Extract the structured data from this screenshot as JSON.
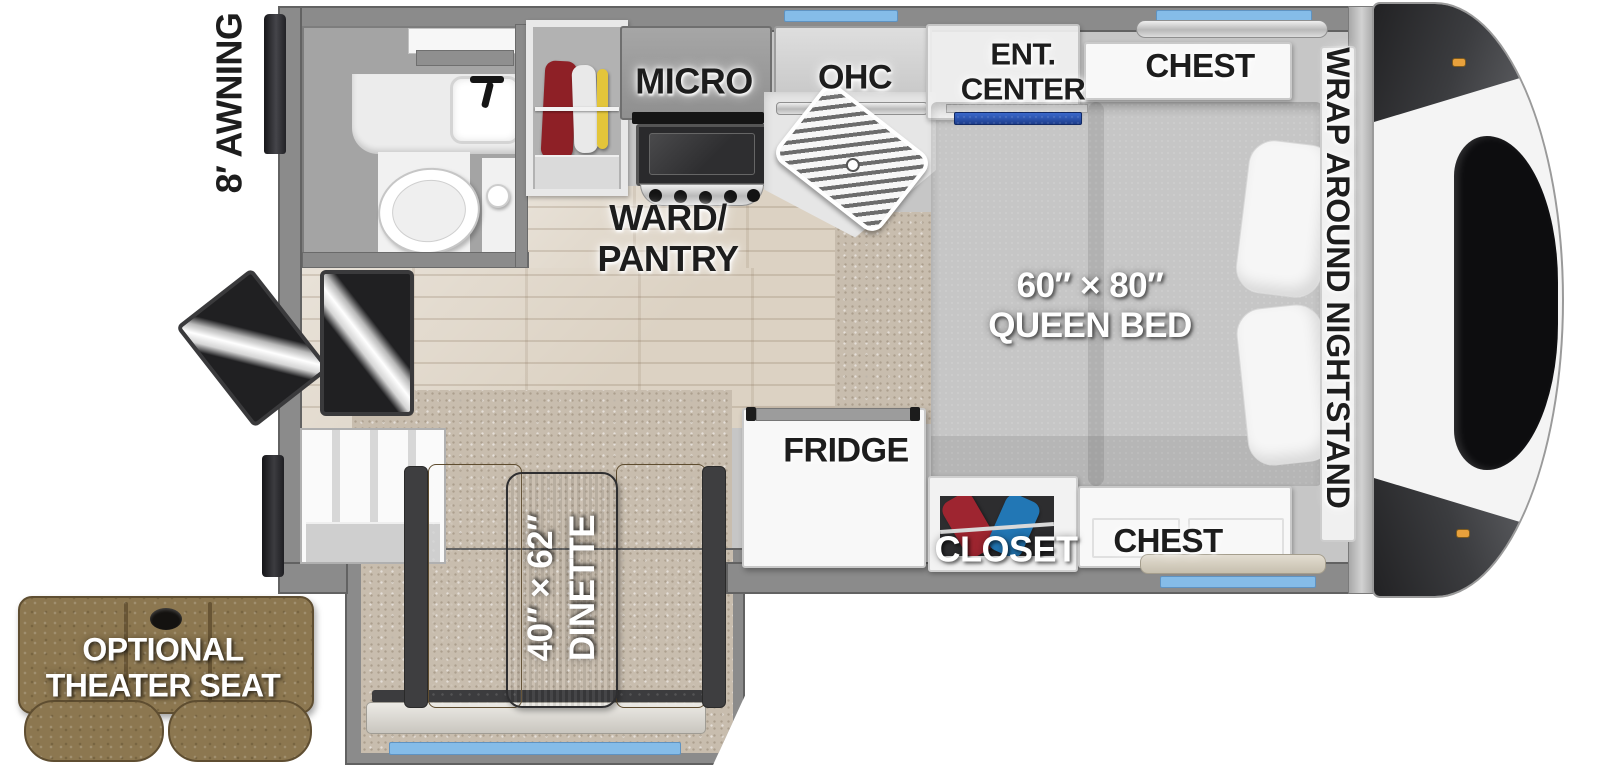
{
  "title": "Truck camper floor plan",
  "labels": {
    "awning": "8′ AWNING",
    "micro": "MICRO",
    "ohc": "OHC",
    "ent_center": "ENT.\nCENTER",
    "chest_top": "CHEST",
    "wrap_nightstand": "WRAP AROUND NIGHTSTAND",
    "queen_bed": "60″ × 80″\nQUEEN BED",
    "ward_pantry": "WARD/\nPANTRY",
    "fridge": "FRIDGE",
    "closet": "CLOSET",
    "chest_bottom": "CHEST",
    "dinette": "40″ × 62″\nDINETTE",
    "theater_seat": "OPTIONAL\nTHEATER SEAT"
  },
  "colors": {
    "wall_gray": "#8b8b8b",
    "window_blue": "#85bce8",
    "tv_blue": "#2b55b4",
    "carpet_tan": "#c8bdae",
    "wood_floor": "#dcd2c3",
    "bed_gray": "#a3a3a3",
    "bench_brown": "#8f744a",
    "theater_seat_brown": "#8c7750",
    "clothes_red": "#8e2026",
    "clothes_blue": "#1f6fa8",
    "clothes_yellow": "#e3c53a",
    "label_dark": "#1d1d1d",
    "label_light": "#ffffff"
  }
}
